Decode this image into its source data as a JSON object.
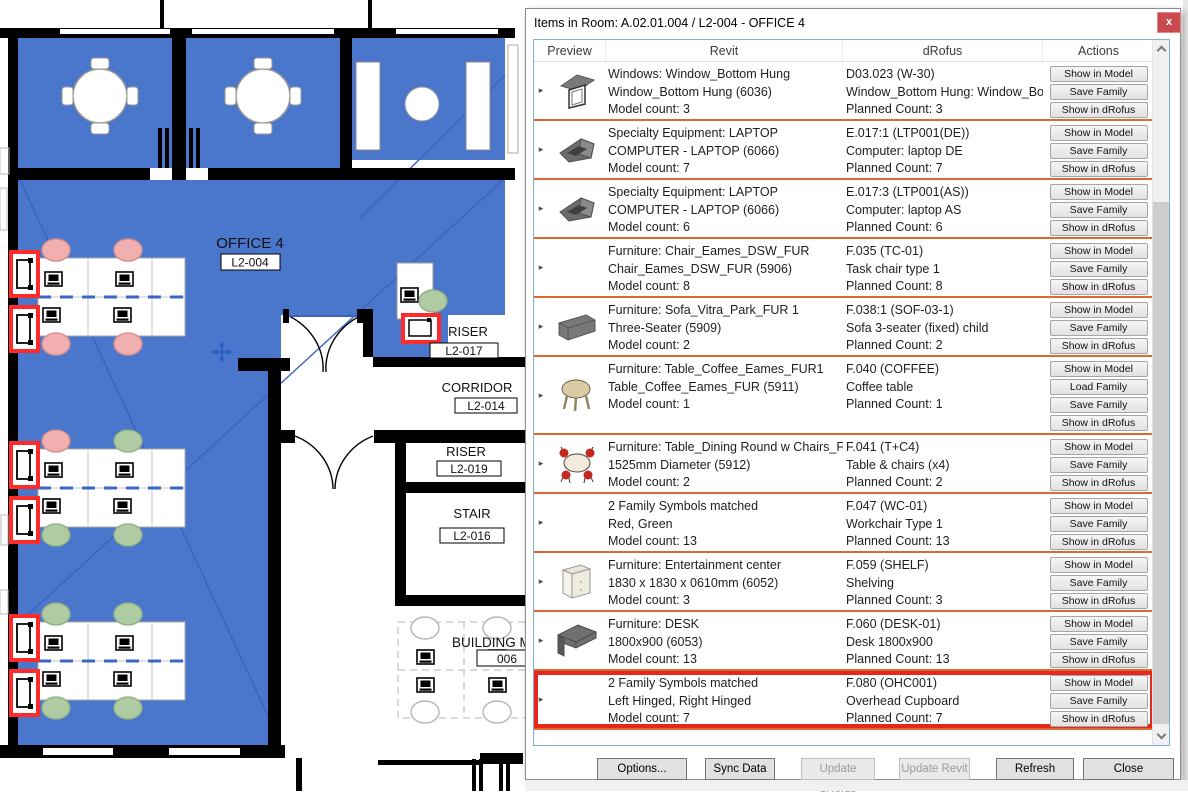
{
  "colors": {
    "plan_blue": "#4A76CB",
    "chair_pink": "#F2AFAF",
    "chair_green": "#AECBA3",
    "plan_highlight_red": "#FF2B2B",
    "row_separator_orange": "#DC6832",
    "row_highlight_red": "#E5271D",
    "close_button_red": "#CB4A50",
    "listbox_border_blue": "#7EB2D4",
    "diagonal_blue": "#3A63C0"
  },
  "plan": {
    "rooms": [
      {
        "name": "OFFICE 4",
        "tag": "L2-004"
      },
      {
        "name": "RISER",
        "tag": "L2-017"
      },
      {
        "name": "CORRIDOR",
        "tag": "L2-014"
      },
      {
        "name": "RISER",
        "tag": "L2-019"
      },
      {
        "name": "STAIR",
        "tag": "L2-016"
      },
      {
        "name": "BUILDING M",
        "tag": "006"
      }
    ]
  },
  "dialog": {
    "title": "Items in Room: A.02.01.004 / L2-004 - OFFICE 4",
    "close_label": "x",
    "table": {
      "columns": [
        "Preview",
        "Revit",
        "dRofus",
        "Actions"
      ],
      "rows": [
        {
          "icon": "window",
          "revit": [
            "Windows: Window_Bottom Hung",
            "Window_Bottom Hung (6036)",
            "Model count: 3"
          ],
          "drofus": [
            "D03.023 (W-30)",
            "Window_Bottom Hung: Window_Bo",
            "Planned Count: 3"
          ],
          "actions": [
            "Show in Model",
            "Save Family",
            "Show in dRofus"
          ],
          "tall": false,
          "highlighted": false
        },
        {
          "icon": "laptop",
          "revit": [
            "Specialty Equipment: LAPTOP",
            "COMPUTER - LAPTOP (6066)",
            "Model count: 7"
          ],
          "drofus": [
            "E.017:1 (LTP001(DE))",
            "Computer: laptop DE",
            "Planned Count: 7"
          ],
          "actions": [
            "Show in Model",
            "Save Family",
            "Show in dRofus"
          ],
          "tall": false,
          "highlighted": false
        },
        {
          "icon": "laptop",
          "revit": [
            "Specialty Equipment: LAPTOP",
            "COMPUTER - LAPTOP (6066)",
            "Model count: 6"
          ],
          "drofus": [
            "E.017:3 (LTP001(AS))",
            "Computer: laptop AS",
            "Planned Count: 6"
          ],
          "actions": [
            "Show in Model",
            "Save Family",
            "Show in dRofus"
          ],
          "tall": false,
          "highlighted": false
        },
        {
          "icon": "none",
          "revit": [
            "Furniture: Chair_Eames_DSW_FUR",
            "Chair_Eames_DSW_FUR (5906)",
            "Model count: 8"
          ],
          "drofus": [
            "F.035 (TC-01)",
            "Task chair type 1",
            "Planned Count: 8"
          ],
          "actions": [
            "Show in Model",
            "Save Family",
            "Show in dRofus"
          ],
          "tall": false,
          "highlighted": false
        },
        {
          "icon": "sofa",
          "revit": [
            "Furniture: Sofa_Vitra_Park_FUR 1",
            "Three-Seater (5909)",
            "Model count: 2"
          ],
          "drofus": [
            "F.038:1 (SOF-03-1)",
            "Sofa 3-seater (fixed) child",
            "Planned Count: 2"
          ],
          "actions": [
            "Show in Model",
            "Save Family",
            "Show in dRofus"
          ],
          "tall": false,
          "highlighted": false
        },
        {
          "icon": "coffee",
          "revit": [
            "Furniture: Table_Coffee_Eames_FUR1",
            "Table_Coffee_Eames_FUR (5911)",
            "Model count: 1"
          ],
          "drofus": [
            "F.040 (COFFEE)",
            "Coffee table",
            "Planned Count: 1"
          ],
          "actions": [
            "Show in Model",
            "Load Family",
            "Save Family",
            "Show in dRofus"
          ],
          "tall": true,
          "highlighted": false
        },
        {
          "icon": "dining",
          "revit": [
            "Furniture: Table_Dining Round w Chairs_FU",
            "1525mm Diameter (5912)",
            "Model count: 2"
          ],
          "drofus": [
            "F.041 (T+C4)",
            "Table & chairs (x4)",
            "Planned Count: 2"
          ],
          "actions": [
            "Show in Model",
            "Save Family",
            "Show in dRofus"
          ],
          "tall": false,
          "highlighted": false
        },
        {
          "icon": "none",
          "revit": [
            "2 Family Symbols matched",
            "Red, Green",
            "Model count: 13"
          ],
          "drofus": [
            "F.047 (WC-01)",
            "Workchair Type 1",
            "Planned Count: 13"
          ],
          "actions": [
            "Show in Model",
            "Save Family",
            "Show in dRofus"
          ],
          "tall": false,
          "highlighted": false
        },
        {
          "icon": "shelf",
          "revit": [
            "Furniture: Entertainment center",
            "1830 x 1830 x 0610mm (6052)",
            "Model count: 3"
          ],
          "drofus": [
            "F.059 (SHELF)",
            "Shelving",
            "Planned Count: 3"
          ],
          "actions": [
            "Show in Model",
            "Save Family",
            "Show in dRofus"
          ],
          "tall": false,
          "highlighted": false
        },
        {
          "icon": "desk",
          "revit": [
            "Furniture: DESK",
            "1800x900 (6053)",
            "Model count: 13"
          ],
          "drofus": [
            "F.060 (DESK-01)",
            "Desk 1800x900",
            "Planned Count: 13"
          ],
          "actions": [
            "Show in Model",
            "Save Family",
            "Show in dRofus"
          ],
          "tall": false,
          "highlighted": false
        },
        {
          "icon": "none",
          "revit": [
            "2 Family Symbols matched",
            "Left Hinged, Right Hinged",
            "Model count: 7"
          ],
          "drofus": [
            "F.080 (OHC001)",
            "Overhead Cupboard",
            "Planned Count: 7"
          ],
          "actions": [
            "Show in Model",
            "Save Family",
            "Show in dRofus"
          ],
          "tall": false,
          "highlighted": true
        }
      ]
    },
    "footer_buttons": [
      {
        "label": "Options...",
        "enabled": true
      },
      {
        "label": "Sync Data",
        "enabled": true
      },
      {
        "label": "Update dRofus",
        "enabled": false
      },
      {
        "label": "Update Revit",
        "enabled": false
      },
      {
        "label": "Refresh",
        "enabled": true
      },
      {
        "label": "Close",
        "enabled": true
      }
    ]
  }
}
